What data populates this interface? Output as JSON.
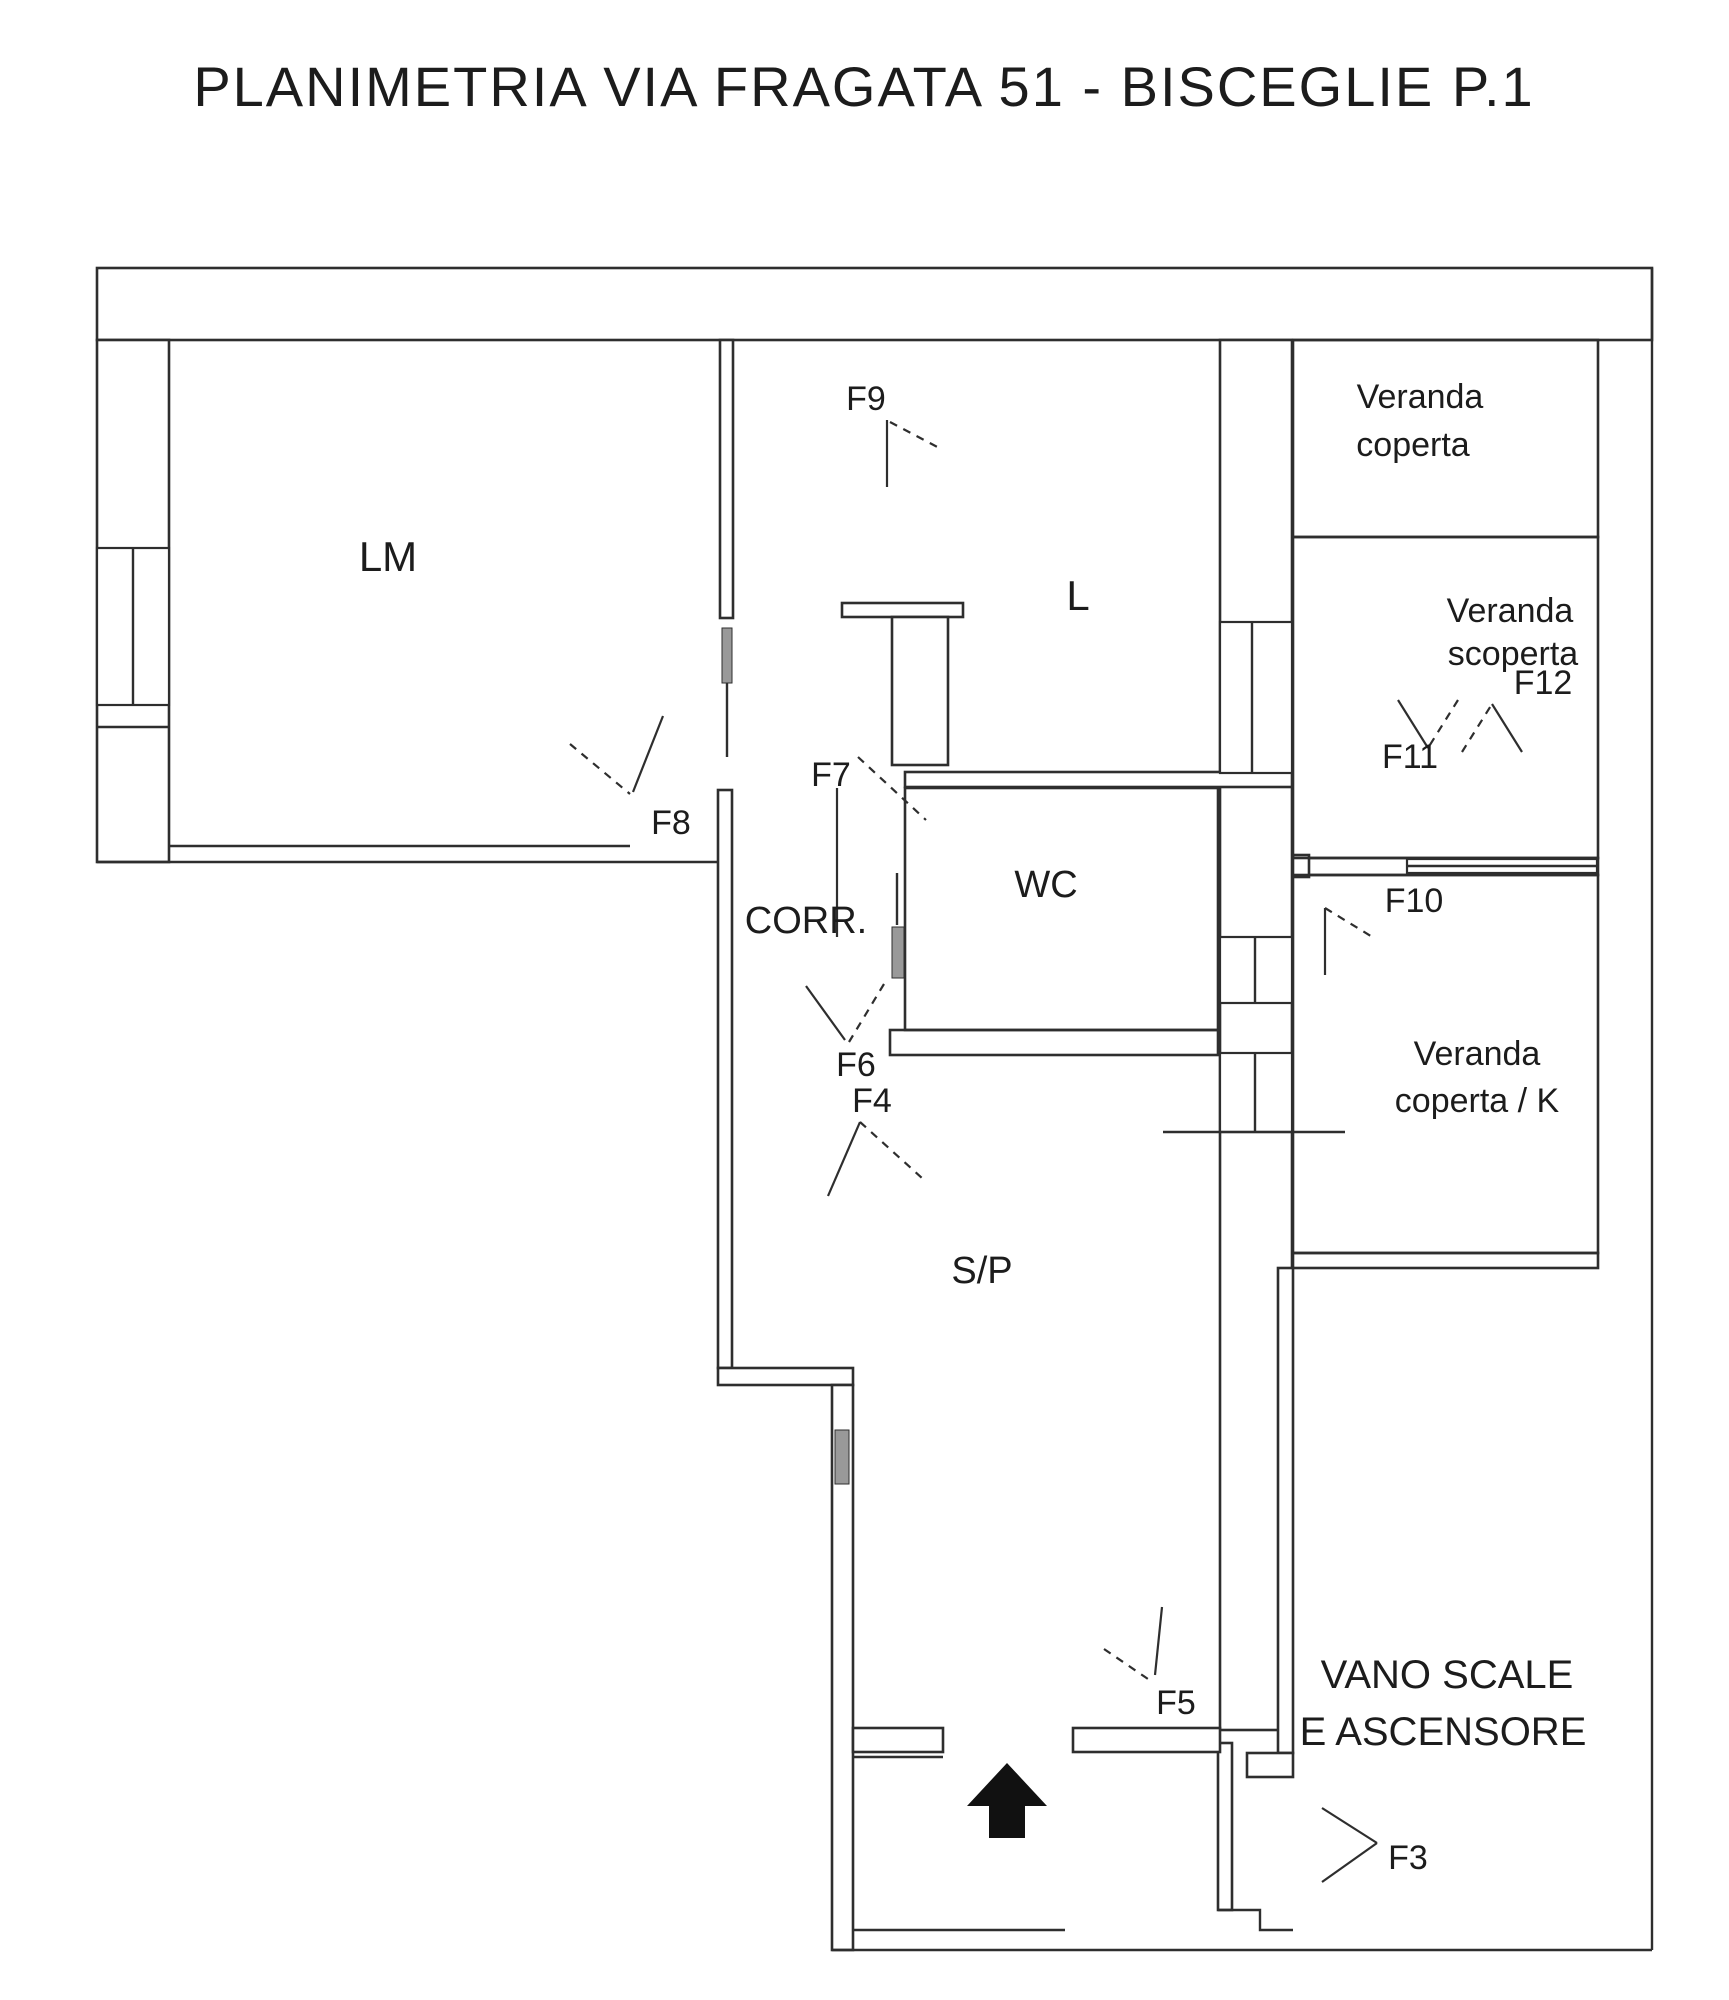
{
  "title": "PLANIMETRIA VIA FRAGATA 51 - BISCEGLIE P.1",
  "canvas": {
    "width": 1729,
    "height": 2000,
    "background": "#ffffff",
    "line_color": "#2e2e2e",
    "leaf_color": "#999999"
  },
  "plan": {
    "wall_bands": [
      {
        "x": 97,
        "y": 268,
        "w": 1555,
        "h": 72,
        "name": "wall-top"
      },
      {
        "x": 97,
        "y": 340,
        "w": 72,
        "h": 522,
        "name": "wall-left"
      },
      {
        "x": 1220,
        "y": 340,
        "w": 72,
        "h": 1390,
        "name": "wall-main-strip-divider"
      },
      {
        "x": 720,
        "y": 340,
        "w": 13,
        "h": 278,
        "name": "wall-lm-l-divider"
      },
      {
        "x": 718,
        "y": 790,
        "w": 14,
        "h": 578,
        "name": "wall-corridor-left"
      },
      {
        "x": 718,
        "y": 1368,
        "w": 135,
        "h": 17,
        "name": "wall-jog"
      },
      {
        "x": 832,
        "y": 1385,
        "w": 21,
        "h": 565,
        "name": "wall-lower-left"
      },
      {
        "x": 842,
        "y": 603,
        "w": 121,
        "h": 14,
        "name": "wall-shaft-top"
      },
      {
        "x": 892,
        "y": 617,
        "w": 56,
        "h": 148,
        "name": "wall-shaft-box"
      },
      {
        "x": 905,
        "y": 772,
        "w": 387,
        "h": 15,
        "name": "wall-l-bottom"
      },
      {
        "x": 890,
        "y": 1030,
        "w": 328,
        "h": 25,
        "name": "wall-wc-bottom"
      },
      {
        "x": 1293,
        "y": 858,
        "w": 305,
        "h": 17,
        "name": "wall-scoperta-k-divider"
      },
      {
        "x": 1293,
        "y": 855,
        "w": 16,
        "h": 22,
        "name": "wall-divider-end-square"
      },
      {
        "x": 1293,
        "y": 1253,
        "w": 305,
        "h": 15,
        "name": "wall-k-bottom"
      },
      {
        "x": 1278,
        "y": 1268,
        "w": 15,
        "h": 485,
        "name": "wall-stairs-left"
      },
      {
        "x": 1247,
        "y": 1753,
        "w": 46,
        "h": 24,
        "name": "wall-stairs-stub"
      },
      {
        "x": 1218,
        "y": 1743,
        "w": 14,
        "h": 167,
        "name": "wall-vestibule-right"
      },
      {
        "x": 853,
        "y": 1728,
        "w": 90,
        "h": 24,
        "name": "wall-sp-bottom-left"
      },
      {
        "x": 1073,
        "y": 1728,
        "w": 147,
        "h": 24,
        "name": "wall-sp-bottom-right"
      }
    ],
    "room_rects": [
      {
        "x": 905,
        "y": 788,
        "w": 313,
        "h": 242,
        "name": "room-wc-outline"
      },
      {
        "x": 1293,
        "y": 340,
        "w": 305,
        "h": 197,
        "name": "room-veranda-coperta-outline"
      },
      {
        "x": 1293,
        "y": 537,
        "w": 305,
        "h": 321,
        "name": "room-veranda-scoperta-outline"
      },
      {
        "x": 1293,
        "y": 875,
        "w": 305,
        "h": 378,
        "name": "room-veranda-k-outline"
      }
    ],
    "window_rects": [
      {
        "x": 97,
        "y": 548,
        "w": 72,
        "h": 157,
        "name": "window-lm-left"
      },
      {
        "x": 1220,
        "y": 622,
        "w": 72,
        "h": 151,
        "name": "window-l-scoperta"
      },
      {
        "x": 1220,
        "y": 937,
        "w": 72,
        "h": 66,
        "name": "window-wc-k"
      },
      {
        "x": 1220,
        "y": 1053,
        "w": 72,
        "h": 79,
        "name": "window-sp-k"
      },
      {
        "x": 1407,
        "y": 859,
        "w": 190,
        "h": 14,
        "name": "window-scoperta-k"
      }
    ],
    "lines": [
      [
        169,
        846,
        630,
        846
      ],
      [
        97,
        862,
        718,
        862
      ],
      [
        97,
        727,
        169,
        727
      ],
      [
        133,
        548,
        133,
        705
      ],
      [
        727,
        683,
        727,
        757
      ],
      [
        897,
        873,
        897,
        925
      ],
      [
        1252,
        622,
        1252,
        773
      ],
      [
        1255,
        937,
        1255,
        1003
      ],
      [
        1255,
        1053,
        1255,
        1132
      ],
      [
        1163,
        1132,
        1345,
        1132
      ],
      [
        1407,
        866,
        1597,
        866
      ],
      [
        853,
        1757,
        943,
        1757
      ],
      [
        853,
        1930,
        1065,
        1930
      ],
      [
        832,
        1950,
        1652,
        1950
      ],
      [
        1652,
        268,
        1652,
        1950
      ]
    ],
    "polylines": [
      [
        [
          1218,
          1910
        ],
        [
          1260,
          1910
        ],
        [
          1260,
          1930
        ],
        [
          1293,
          1930
        ]
      ]
    ],
    "leaf_rects": [
      {
        "x": 722,
        "y": 628,
        "w": 10,
        "h": 55,
        "name": "door-leaf-lm"
      },
      {
        "x": 892,
        "y": 927,
        "w": 12,
        "h": 51,
        "name": "door-leaf-wc"
      },
      {
        "x": 835,
        "y": 1430,
        "w": 14,
        "h": 54,
        "name": "window-bar-sp-left"
      }
    ],
    "swing_solid": [
      [
        1322,
        1808,
        1377,
        1843
      ],
      [
        1322,
        1882,
        1377,
        1843
      ],
      [
        828,
        1196,
        860,
        1122
      ],
      [
        1162,
        1607,
        1155,
        1675
      ],
      [
        806,
        986,
        845,
        1040
      ],
      [
        837,
        788,
        837,
        937
      ],
      [
        663,
        716,
        633,
        792
      ],
      [
        887,
        420,
        887,
        487
      ],
      [
        1325,
        908,
        1325,
        975
      ],
      [
        1398,
        700,
        1428,
        748
      ],
      [
        1492,
        704,
        1522,
        752
      ]
    ],
    "swing_dashed": [
      [
        860,
        1122,
        922,
        1178
      ],
      [
        1104,
        1649,
        1148,
        1679
      ],
      [
        884,
        984,
        849,
        1042
      ],
      [
        858,
        757,
        926,
        820
      ],
      [
        570,
        744,
        630,
        794
      ],
      [
        890,
        422,
        943,
        450
      ],
      [
        1325,
        908,
        1374,
        938
      ],
      [
        1458,
        700,
        1428,
        748
      ],
      [
        1462,
        752,
        1492,
        704
      ]
    ],
    "arrow": {
      "head": [
        [
          967,
          1806
        ],
        [
          1047,
          1806
        ],
        [
          1007,
          1763
        ]
      ],
      "stem": {
        "x": 989,
        "y": 1806,
        "w": 36,
        "h": 32
      }
    }
  },
  "room_labels": [
    {
      "text": "LM",
      "x": 388,
      "y": 571,
      "size": 42,
      "name": "room-label-lm"
    },
    {
      "text": "L",
      "x": 1078,
      "y": 610,
      "size": 42,
      "name": "room-label-l"
    },
    {
      "text": "CORR.",
      "x": 806,
      "y": 933,
      "size": 38,
      "name": "room-label-corridor"
    },
    {
      "text": "WC",
      "x": 1046,
      "y": 897,
      "size": 38,
      "name": "room-label-wc"
    },
    {
      "text": "S/P",
      "x": 982,
      "y": 1283,
      "size": 38,
      "name": "room-label-sp"
    },
    {
      "text": "Veranda",
      "x": 1420,
      "y": 408,
      "size": 34,
      "name": "room-label-veranda-coperta-1"
    },
    {
      "text": "coperta",
      "x": 1413,
      "y": 456,
      "size": 34,
      "name": "room-label-veranda-coperta-2"
    },
    {
      "text": "Veranda",
      "x": 1510,
      "y": 622,
      "size": 34,
      "name": "room-label-veranda-scoperta-1"
    },
    {
      "text": "scoperta",
      "x": 1513,
      "y": 665,
      "size": 34,
      "name": "room-label-veranda-scoperta-2"
    },
    {
      "text": "Veranda",
      "x": 1477,
      "y": 1065,
      "size": 34,
      "name": "room-label-veranda-k-1"
    },
    {
      "text": "coperta / K",
      "x": 1477,
      "y": 1112,
      "size": 34,
      "name": "room-label-veranda-k-2"
    },
    {
      "text": "VANO SCALE",
      "x": 1447,
      "y": 1688,
      "size": 40,
      "name": "room-label-vano-scale-1"
    },
    {
      "text": "E ASCENSORE",
      "x": 1443,
      "y": 1745,
      "size": 40,
      "name": "room-label-vano-scale-2"
    }
  ],
  "window_labels": [
    {
      "text": "F3",
      "x": 1408,
      "y": 1869,
      "size": 34,
      "name": "window-label-f3"
    },
    {
      "text": "F4",
      "x": 872,
      "y": 1112,
      "size": 34,
      "name": "window-label-f4"
    },
    {
      "text": "F5",
      "x": 1176,
      "y": 1714,
      "size": 34,
      "name": "window-label-f5"
    },
    {
      "text": "F6",
      "x": 856,
      "y": 1076,
      "size": 34,
      "name": "window-label-f6"
    },
    {
      "text": "F7",
      "x": 831,
      "y": 786,
      "size": 34,
      "name": "window-label-f7"
    },
    {
      "text": "F8",
      "x": 671,
      "y": 834,
      "size": 34,
      "name": "window-label-f8"
    },
    {
      "text": "F9",
      "x": 866,
      "y": 410,
      "size": 34,
      "name": "window-label-f9"
    },
    {
      "text": "F10",
      "x": 1414,
      "y": 912,
      "size": 34,
      "name": "window-label-f10"
    },
    {
      "text": "F11",
      "x": 1410,
      "y": 768,
      "size": 34,
      "name": "window-label-f11"
    },
    {
      "text": "F12",
      "x": 1543,
      "y": 694,
      "size": 34,
      "name": "window-label-f12"
    }
  ]
}
